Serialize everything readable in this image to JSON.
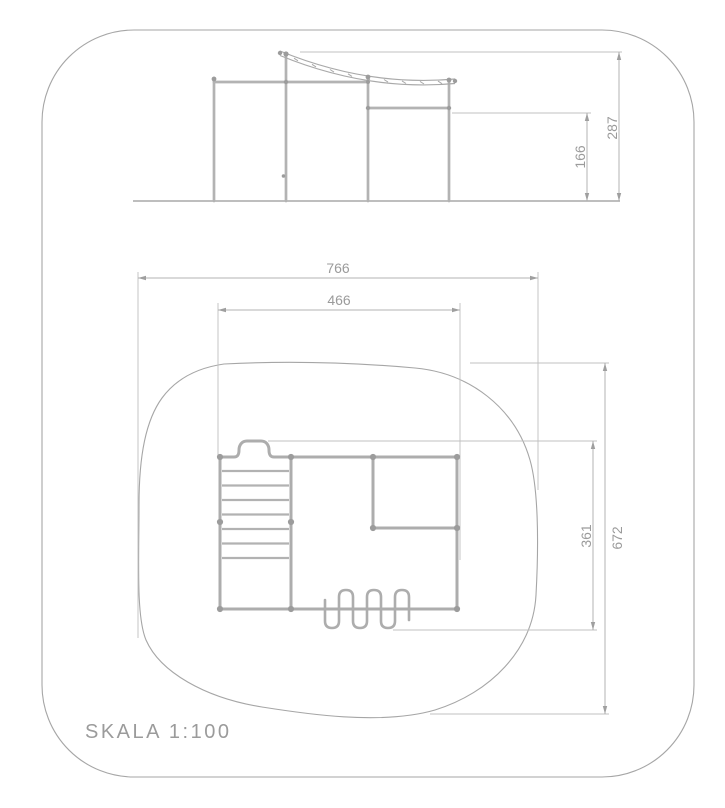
{
  "drawing": {
    "scale_label": "SKALA 1:100",
    "elevation_dims": {
      "bar_height": "166",
      "total_height": "287"
    },
    "plan_dims": {
      "zone_width": "766",
      "frame_width": "466",
      "frame_depth": "361",
      "zone_depth": "672"
    },
    "colors": {
      "tube_gray": "#adadad",
      "dim_line_gray": "#b3b3b3",
      "text_gray": "#9b9b9b",
      "outline_gray": "#a6a6a6"
    }
  }
}
